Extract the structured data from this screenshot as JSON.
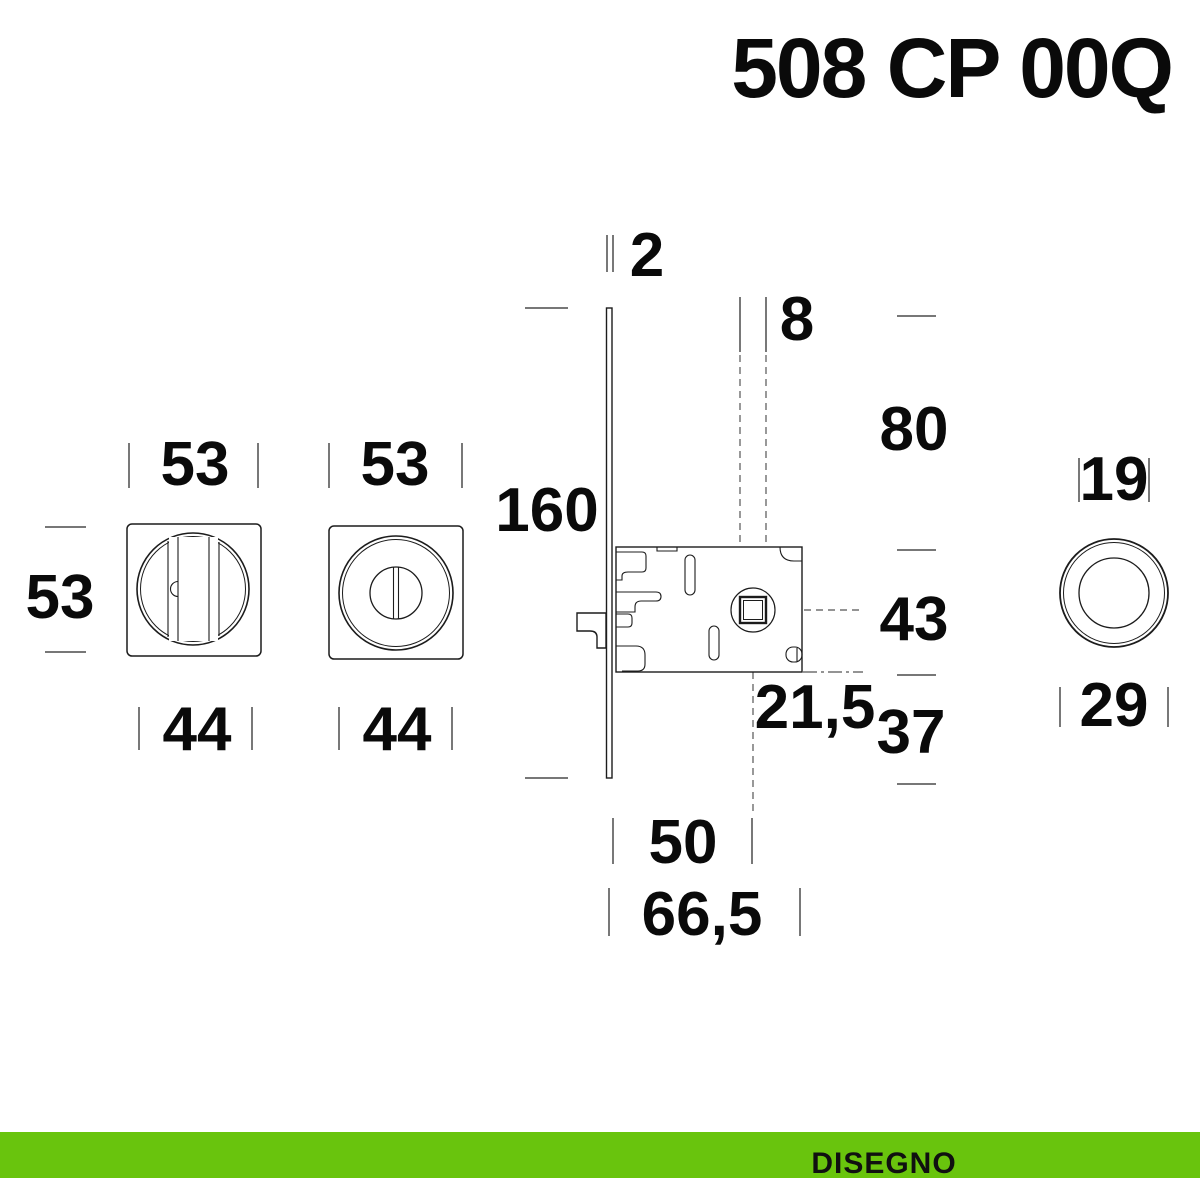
{
  "title": "508 CP 00Q",
  "footer": {
    "label": "DISEGNO",
    "bar_color": "#69c40d"
  },
  "colors": {
    "background": "#ffffff",
    "line": "#1c1c1c",
    "dim_tick": "#4a4a4a",
    "text": "#0a0a0a",
    "accent_green": "#69c40d"
  },
  "dimensions": {
    "faceplate_thickness": "2",
    "spindle_square": "8",
    "faceplate_length": "160",
    "edge_to_lock_top": "80",
    "lock_body_height": "43",
    "lock_bottom_offset": "37",
    "spindle_below_lock": "21,5",
    "backset": "50",
    "lock_depth": "66,5",
    "rosette_width_left": "53",
    "rosette_width_right": "53",
    "rosette_height": "53",
    "rosette_inner_left": "44",
    "rosette_inner_right": "44",
    "pull_recess_diameter": "19",
    "pull_outer_diameter": "29"
  }
}
